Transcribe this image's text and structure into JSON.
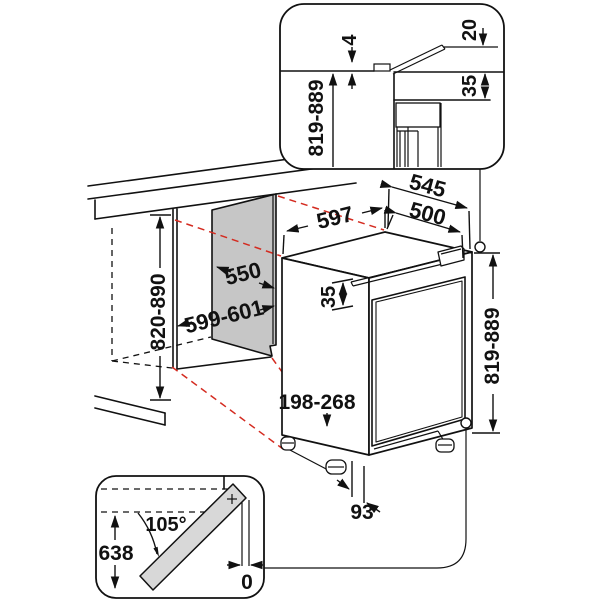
{
  "diagram": {
    "title": "built-under appliance installation drawing",
    "colors": {
      "line": "#111111",
      "projection_red": "#d42b20",
      "panel_gray": "#c6c6c6",
      "door_gray": "#d8d8d8",
      "background": "#ffffff"
    },
    "top_inset": {
      "worktop_gap": "4",
      "flap_height": "20",
      "niche_height": "819-889",
      "top_clearance": "35"
    },
    "main": {
      "niche_height": "820-890",
      "niche_depth": "550",
      "niche_width": "599-601",
      "appliance_width": "597",
      "worktop_depth": "545",
      "appliance_depth": "500",
      "top_clearance": "35",
      "appliance_height": "819-889",
      "plinth_height": "198-268",
      "plinth_recess": "93"
    },
    "door_inset": {
      "opening_angle": "105°",
      "door_swing": "638",
      "side_clearance": "0",
      "hinge_marker": "+"
    }
  }
}
